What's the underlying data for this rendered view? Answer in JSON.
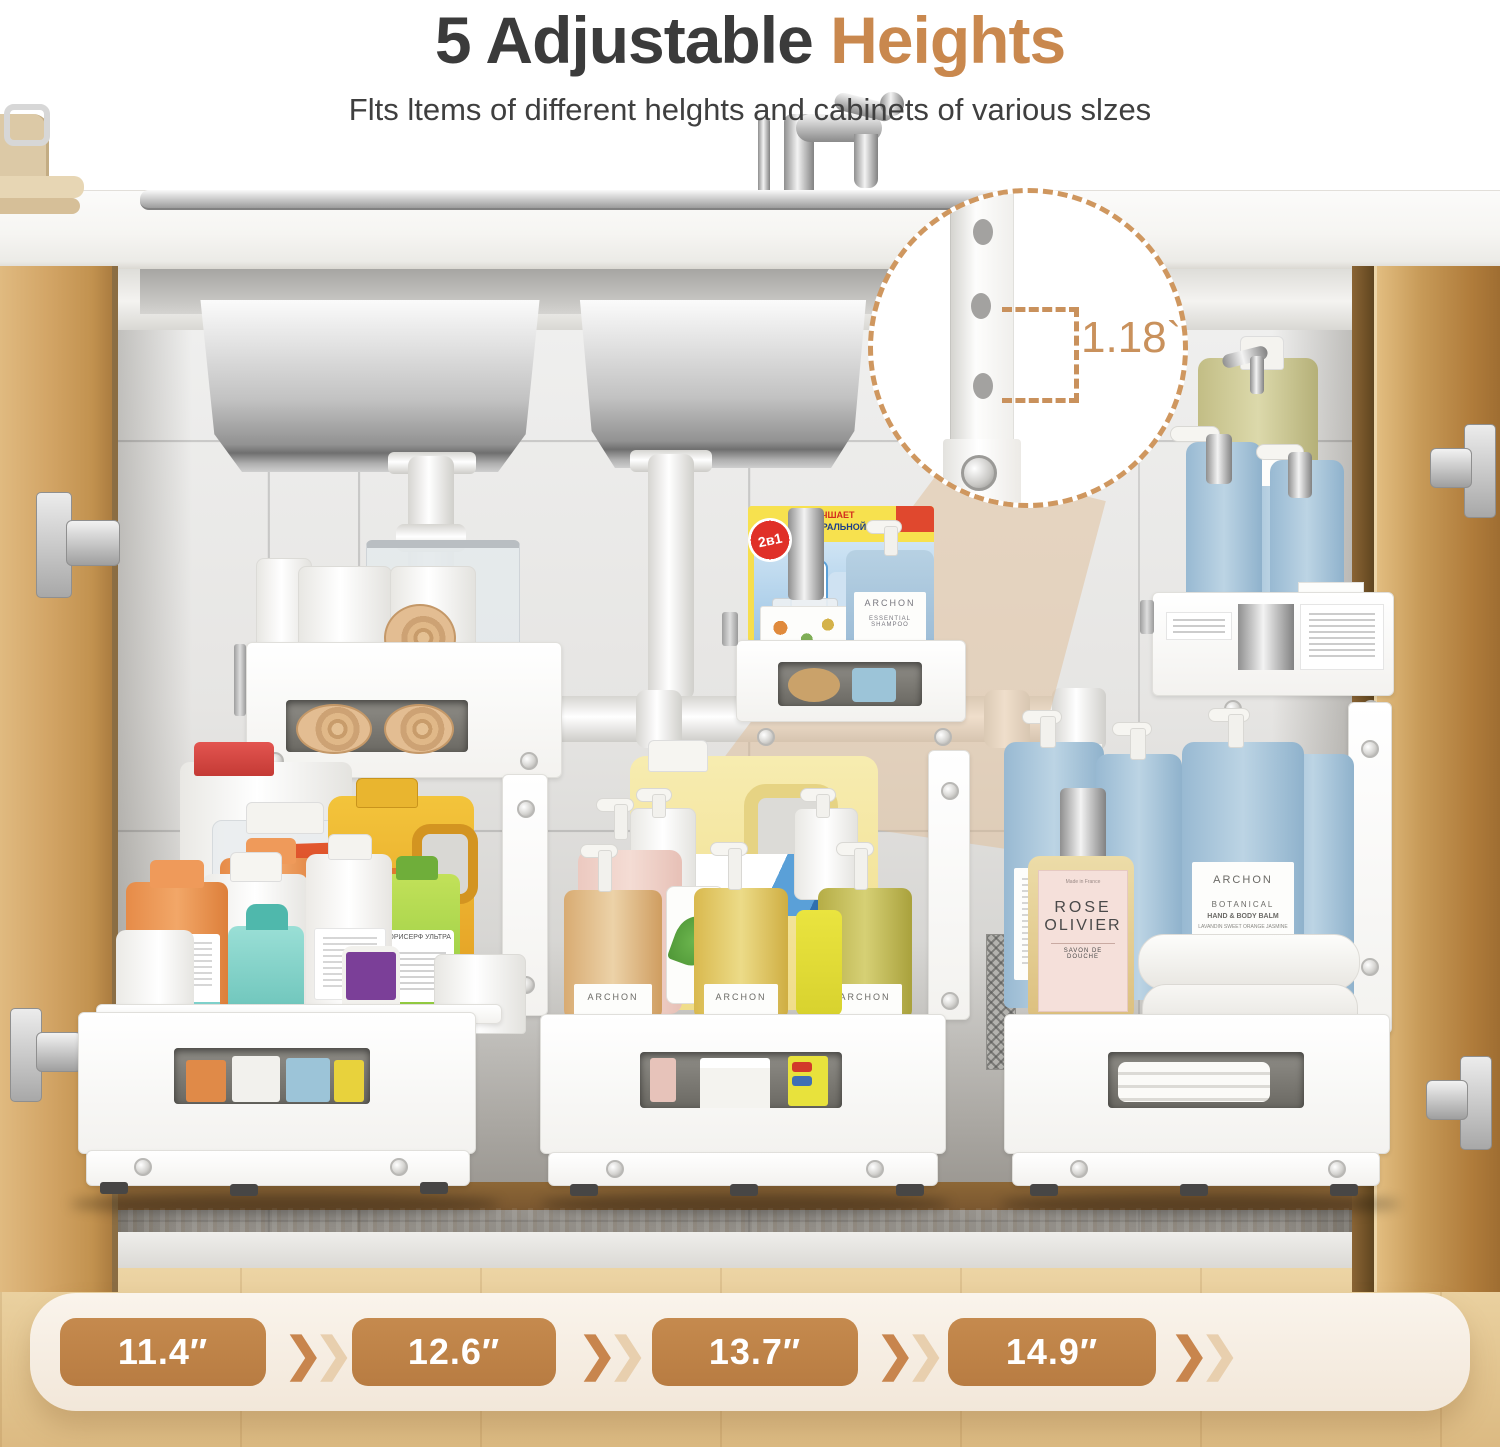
{
  "header": {
    "title_dark": "5 Adjustable",
    "title_accent": "Heights",
    "subtitle": "Flts ltems of different helghts and cabinets of various slzes"
  },
  "callout": {
    "measurement": "1.18``"
  },
  "heights_bar": {
    "values": [
      "11.4″",
      "12.6″",
      "13.7″",
      "14.9″",
      "16.14″"
    ]
  },
  "icons": {
    "chevron": "❯"
  },
  "products": {
    "detergent_box_badge": "2в1",
    "detergent_box_banner1": "УЛУЧШАЕТ",
    "detergent_box_banner2": "НАТУРАЛЬНОЙ МАШИНЫ",
    "shampoo_brand": "ARCHON",
    "shampoo_type": "ESSENTIAL SHAMPOO",
    "pump_brand": "ARCHON",
    "balm_brand": "ARCHON",
    "balm_collection": "BOTANICAL",
    "balm_type": "HAND & BODY BALM",
    "balm_scent": "LAVANDIN SWEET ORANGE JASMINE",
    "rose_origin": "Made in France",
    "rose_line1": "ROSE",
    "rose_line2": "OLIVIER",
    "rose_type": "SAVON DE DOUCHE",
    "gold_jug_brand": "Mabel's",
    "green_bottle_label": "ФОРИСЕРФ УЛЬТРА",
    "orange_box_label": "DETERGENT"
  },
  "colors": {
    "accent": "#c9884e",
    "title": "#3b3b3b",
    "pill": "#c08449",
    "pill_text": "#ffffff",
    "blue_bottle": "#a9c6dc",
    "wood": "#d2a465",
    "dash": "#cf975f"
  }
}
